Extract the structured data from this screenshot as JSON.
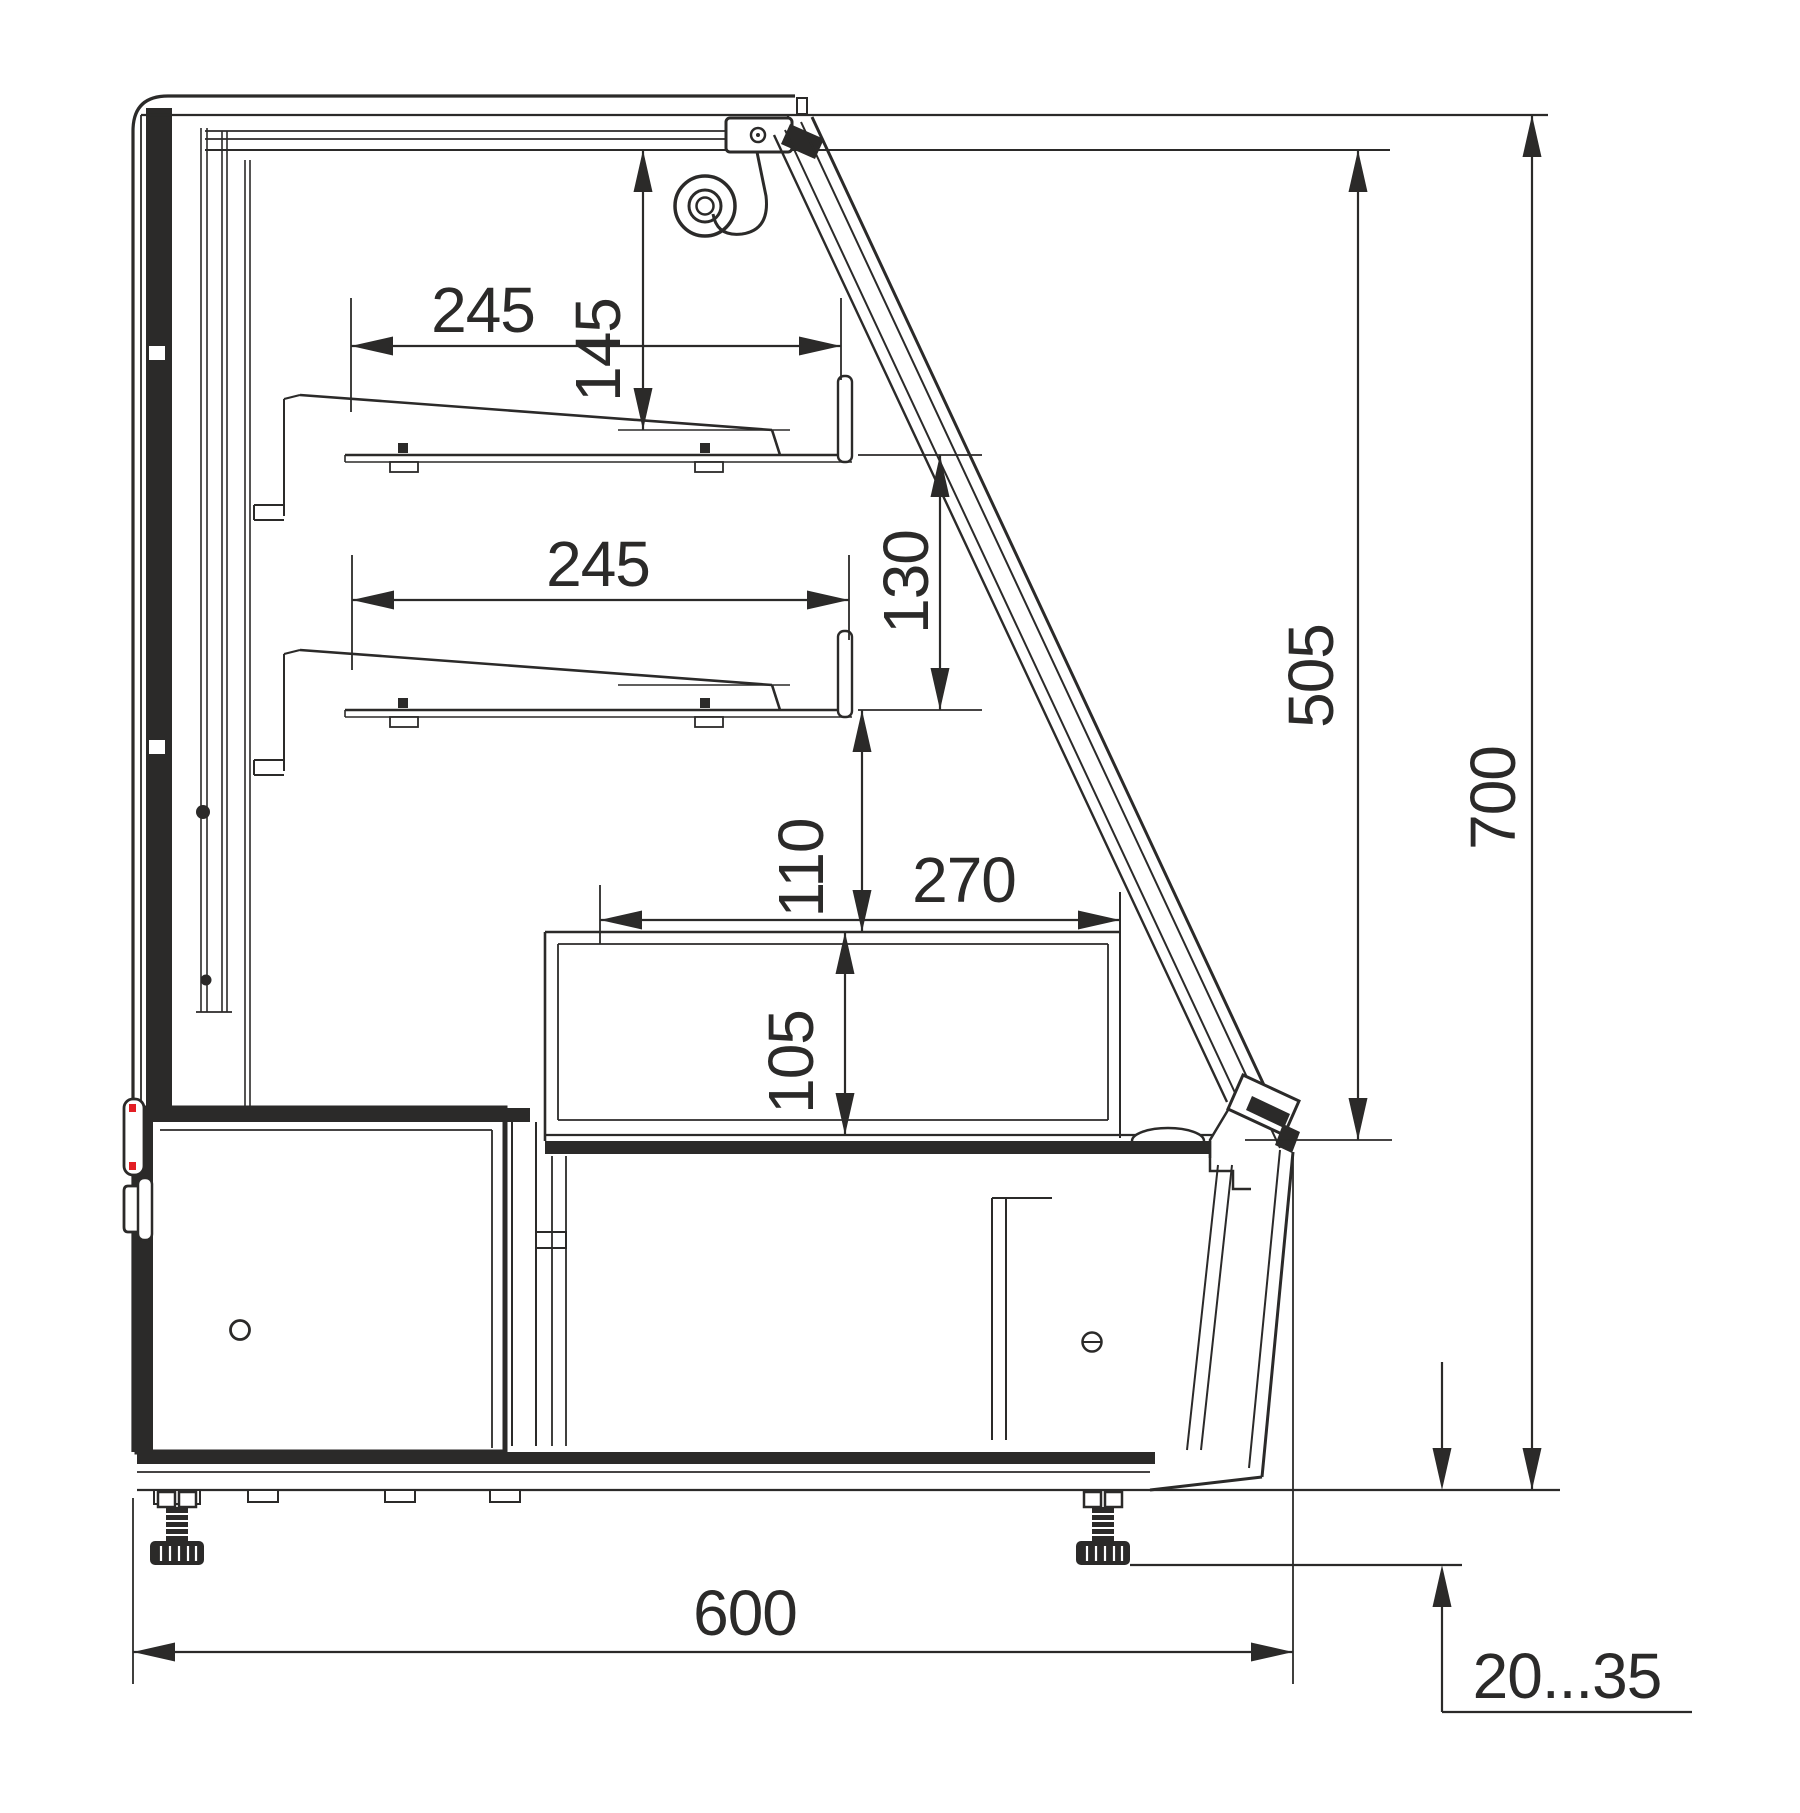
{
  "drawing": {
    "title": "Display case cross-section",
    "dimensions": {
      "shelf_upper_depth": "245",
      "canopy_to_shelf_height": "145",
      "shelf_lower_depth": "245",
      "shelf_gap_height": "130",
      "glass_front_height": "505",
      "total_height": "700",
      "shelf_to_deck_height": "110",
      "well_depth_horizontal": "270",
      "well_depth_vertical": "105",
      "total_depth": "600",
      "leg_adjust_range": "20...35"
    },
    "colors": {
      "line": "#2b2a29",
      "indicator_red": "#e31e24",
      "background": "#ffffff"
    }
  }
}
